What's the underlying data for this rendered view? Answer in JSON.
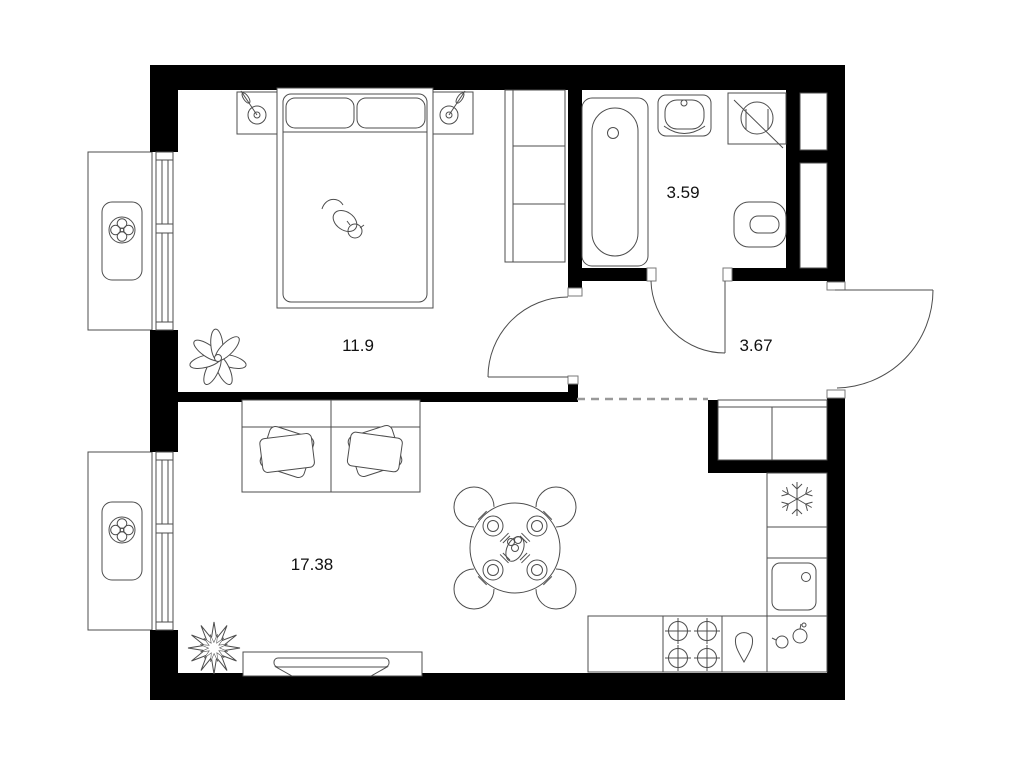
{
  "rooms": [
    {
      "name": "bedroom",
      "area": "11.9"
    },
    {
      "name": "bathroom",
      "area": "3.59"
    },
    {
      "name": "hallway",
      "area": "3.67"
    },
    {
      "name": "living-room-kitchen",
      "area": "17.38"
    }
  ],
  "colors": {
    "wall": "#000000",
    "furniture_line": "#4d4d4d",
    "dashed_zone_line": "#999999",
    "background": "#ffffff",
    "label_text": "#111111"
  },
  "icons": [
    "fan-icon",
    "lamp-icon",
    "cat-icon",
    "plant-icon",
    "spiky-plant-icon",
    "snowflake-icon",
    "burner-icon",
    "drop-icon",
    "fruit-icon",
    "washing-machine-icon",
    "door-swing-arc"
  ]
}
